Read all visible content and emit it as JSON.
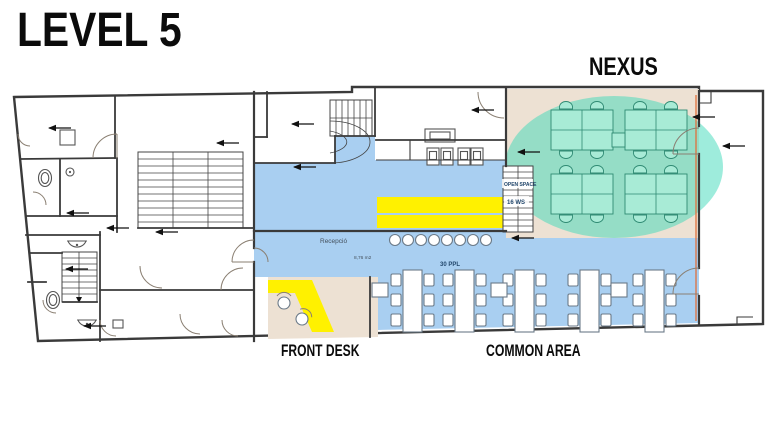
{
  "page": {
    "title": "LEVEL 5"
  },
  "zones": {
    "nexus_label": "NEXUS",
    "front_desk_label": "FRONT DESK",
    "common_area_label": "COMMON AREA"
  },
  "plan": {
    "reception_label": "Recepció",
    "reception_area_m2": "8,76 m2",
    "common_area_capacity": "30 PPL",
    "open_space_label": "OPEN SPACE",
    "open_space_workstations": "16 WS"
  },
  "counts": {
    "nexus_desk_banks": 4,
    "nexus_workstations": 16,
    "common_long_tables": 5,
    "common_side_tables": 3,
    "bar_stools": 8
  },
  "colors": {
    "zone_blue": "#A9CFF1",
    "zone_beige": "#EDE1D3",
    "highlight_yellow": "#FFF100",
    "highlight_teal": "#3ED9B9",
    "desk_teal": "#A8EBD6",
    "desk_stroke": "#2F8A73",
    "wall": "#3A3A3A",
    "accent_orange": "#E0703C"
  }
}
